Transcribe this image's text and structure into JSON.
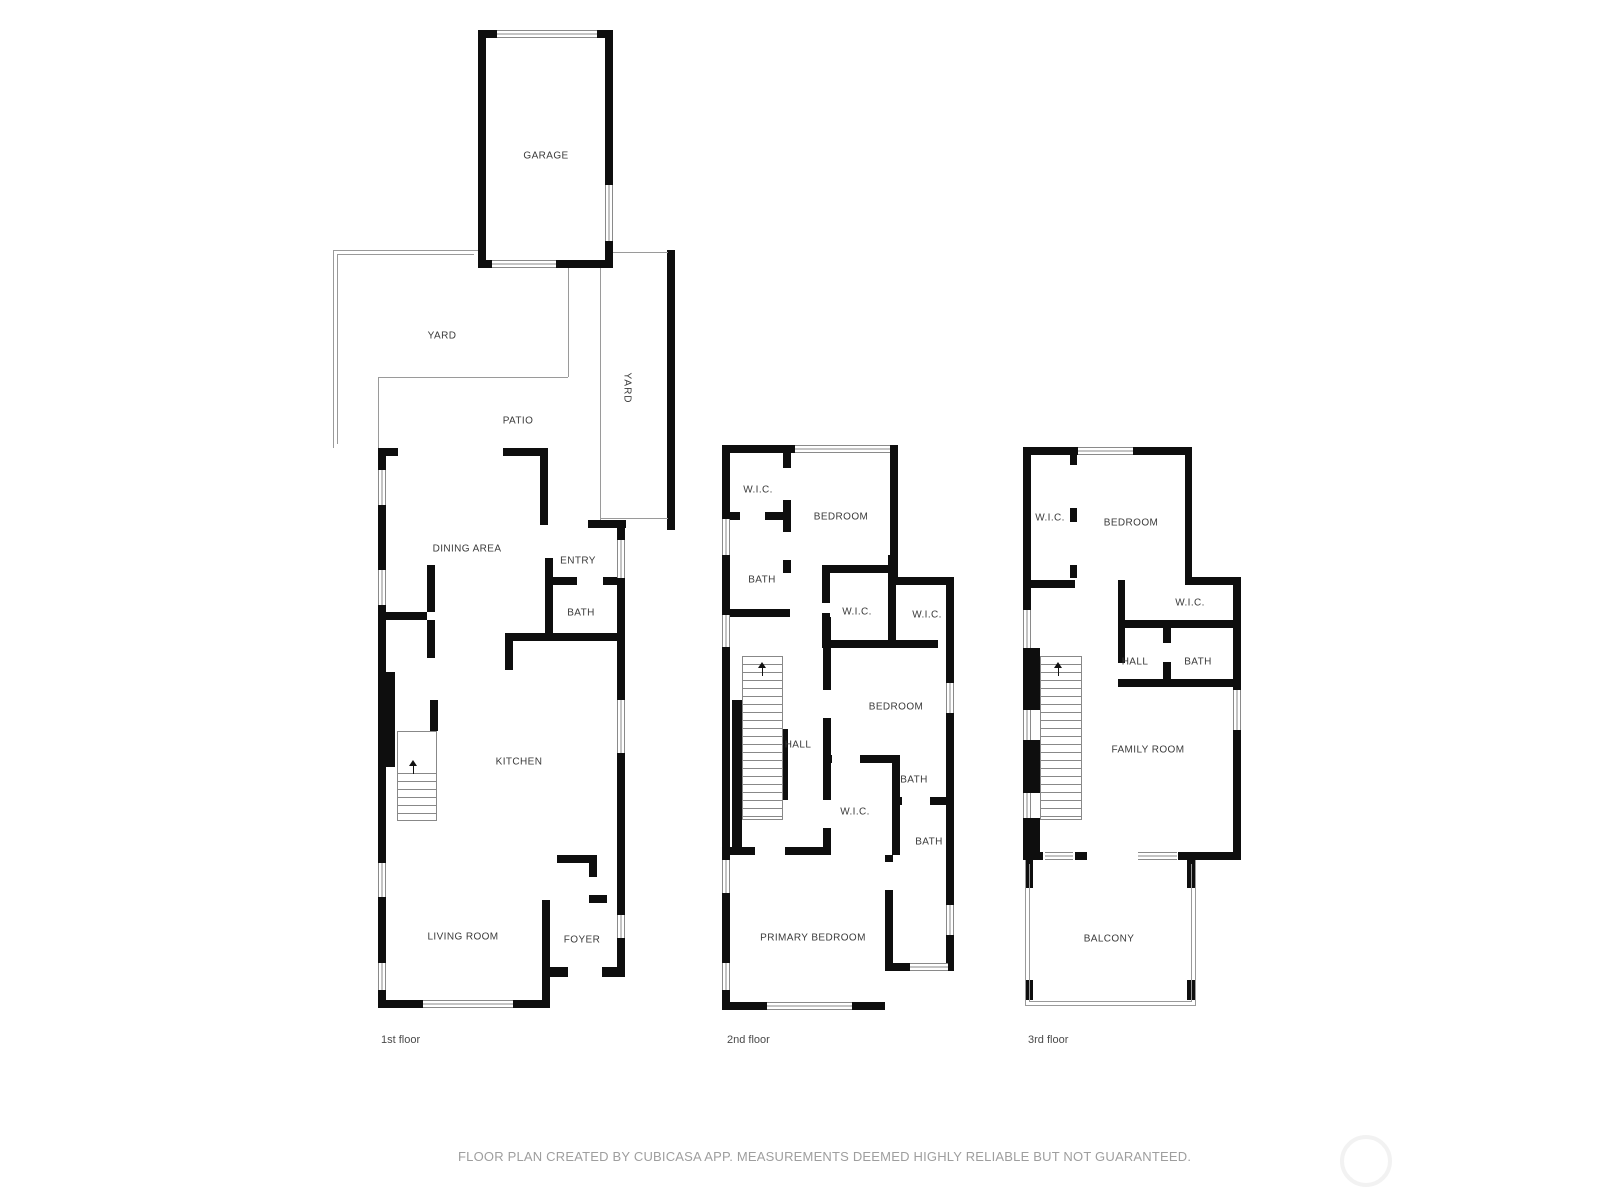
{
  "page": {
    "background": "#ffffff"
  },
  "colors": {
    "wall": "#0e0e0e",
    "thin_line": "#9a9a9a",
    "window_line": "#8a8a8a",
    "room_label": "#3a3a3a",
    "caption": "#4a4a4a",
    "footer": "#9e9e9e"
  },
  "floors": [
    {
      "caption": "1st floor",
      "rooms": [
        {
          "label": "GARAGE"
        },
        {
          "label": "YARD"
        },
        {
          "label": "PATIO"
        },
        {
          "label": "YARD"
        },
        {
          "label": "DINING AREA"
        },
        {
          "label": "ENTRY"
        },
        {
          "label": "BATH"
        },
        {
          "label": "KITCHEN"
        },
        {
          "label": "LIVING ROOM"
        },
        {
          "label": "FOYER"
        }
      ]
    },
    {
      "caption": "2nd floor",
      "rooms": [
        {
          "label": "W.I.C."
        },
        {
          "label": "BEDROOM"
        },
        {
          "label": "BATH"
        },
        {
          "label": "W.I.C."
        },
        {
          "label": "W.I.C."
        },
        {
          "label": "BEDROOM"
        },
        {
          "label": "HALL"
        },
        {
          "label": "BATH"
        },
        {
          "label": "W.I.C."
        },
        {
          "label": "BATH"
        },
        {
          "label": "PRIMARY BEDROOM"
        }
      ]
    },
    {
      "caption": "3rd floor",
      "rooms": [
        {
          "label": "W.I.C."
        },
        {
          "label": "BEDROOM"
        },
        {
          "label": "W.I.C."
        },
        {
          "label": "HALL"
        },
        {
          "label": "BATH"
        },
        {
          "label": "FAMILY ROOM"
        },
        {
          "label": "BALCONY"
        }
      ]
    }
  ],
  "footer": {
    "disclaimer": "FLOOR PLAN CREATED BY CUBICASA APP. MEASUREMENTS DEEMED HIGHLY RELIABLE BUT NOT GUARANTEED."
  }
}
